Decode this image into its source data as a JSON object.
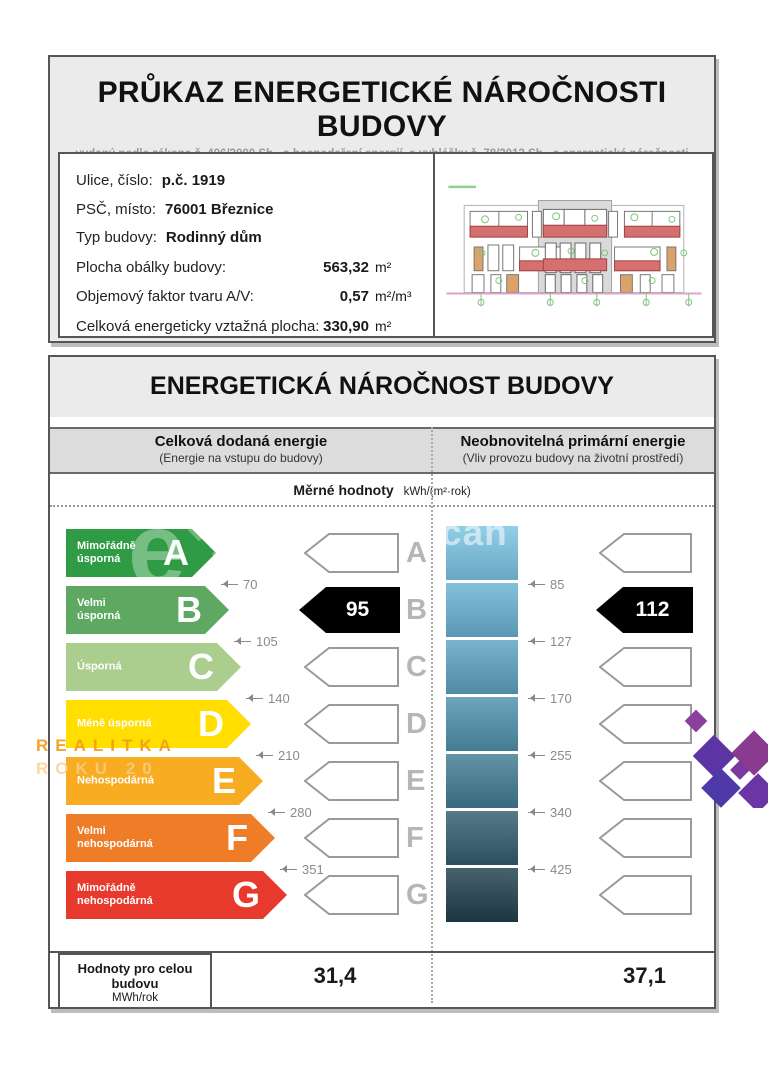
{
  "header": {
    "title": "PRŮKAZ ENERGETICKÉ NÁROČNOSTI BUDOVY",
    "subtitle": "vydaný podle zákona č. 406/2000 Sb., o hospodaření energií, a vyhlášky č. 78/2013 Sb., o energetické náročnosti budov"
  },
  "info": {
    "rows": [
      {
        "label": "Ulice, číslo:",
        "value": "p.č. 1919",
        "unit": ""
      },
      {
        "label": "PSČ, místo:",
        "value": "76001 Březnice",
        "unit": ""
      },
      {
        "label": "Typ budovy:",
        "value": "Rodinný dům",
        "unit": ""
      },
      {
        "label": "Plocha obálky budovy:",
        "value": "563,32",
        "unit": "m²"
      },
      {
        "label": "Objemový faktor tvaru A/V:",
        "value": "0,57",
        "unit": "m²/m³"
      },
      {
        "label": "Celková energeticky vztažná plocha:",
        "value": "330,90",
        "unit": "m²"
      }
    ]
  },
  "main": {
    "title": "ENERGETICKÁ NÁROČNOST BUDOVY",
    "columns": {
      "left": {
        "title": "Celková dodaná energie",
        "subtitle": "(Energie na vstupu do budovy)"
      },
      "right": {
        "title": "Neobnovitelná primární energie",
        "subtitle": "(Vliv provozu budovy na životní prostředí)"
      }
    },
    "units_label": "Měrné hodnoty",
    "units_value": "kWh/(m²·rok)",
    "scale": {
      "rows": [
        {
          "letter": "A",
          "label_lines": [
            "Mimořádně",
            "úsporná"
          ],
          "color": "#2F9C45",
          "block_color": "#7AC4E4",
          "threshold_left": "70",
          "threshold_right": "85"
        },
        {
          "letter": "B",
          "label_lines": [
            "Velmi",
            "úsporná"
          ],
          "color": "#5FA862",
          "block_color": "#69B2D4",
          "threshold_left": "105",
          "threshold_right": "127"
        },
        {
          "letter": "C",
          "label_lines": [
            "Úsporná"
          ],
          "color": "#ABCD8E",
          "block_color": "#5CA3C2",
          "threshold_left": "140",
          "threshold_right": "170"
        },
        {
          "letter": "D",
          "label_lines": [
            "Méně úsporná"
          ],
          "color": "#FFDE00",
          "block_color": "#4E91AD",
          "threshold_left": "210",
          "threshold_right": "255"
        },
        {
          "letter": "E",
          "label_lines": [
            "Nehospodárná"
          ],
          "color": "#F7AC21",
          "block_color": "#427B93",
          "threshold_left": "280",
          "threshold_right": "340"
        },
        {
          "letter": "F",
          "label_lines": [
            "Velmi",
            "nehospodárná"
          ],
          "color": "#EF7D27",
          "block_color": "#315D70",
          "threshold_left": "351",
          "threshold_right": "425"
        },
        {
          "letter": "G",
          "label_lines": [
            "Mimořádně",
            "nehospodárná"
          ],
          "color": "#E8392D",
          "block_color": "#20404D",
          "threshold_left": "",
          "threshold_right": ""
        }
      ],
      "left_value": {
        "value": "95",
        "row": "B"
      },
      "right_value": {
        "value": "112",
        "row": "B"
      }
    },
    "totals": {
      "label": "Hodnoty pro celou budovu",
      "unit": "MWh/rok",
      "left_value": "31,4",
      "right_value": "37,1"
    }
  },
  "watermarks": {
    "e_text": "e",
    "can_text": "can",
    "realitka_line1": "REALITKA",
    "realitka_line2": "ROKU 20"
  }
}
